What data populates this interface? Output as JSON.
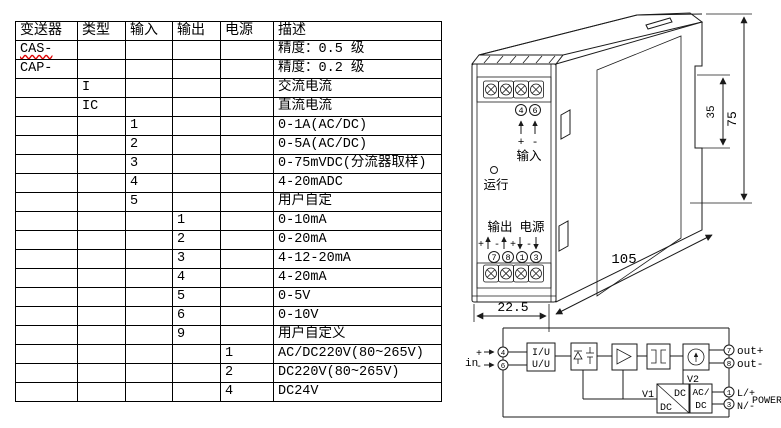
{
  "table": {
    "headers": [
      "变送器",
      "类型",
      "输入",
      "输出",
      "电源",
      "描述"
    ],
    "rows": [
      {
        "cells": [
          "CAS-",
          "",
          "",
          "",
          "",
          "精度：0.5 级"
        ],
        "spell_underline": true
      },
      {
        "cells": [
          "CAP-",
          "",
          "",
          "",
          "",
          "精度：0.2 级"
        ]
      },
      {
        "cells": [
          "",
          "I",
          "",
          "",
          "",
          "交流电流"
        ]
      },
      {
        "cells": [
          "",
          "IC",
          "",
          "",
          "",
          "直流电流"
        ]
      },
      {
        "cells": [
          "",
          "",
          "1",
          "",
          "",
          "0-1A(AC/DC)"
        ]
      },
      {
        "cells": [
          "",
          "",
          "2",
          "",
          "",
          "0-5A(AC/DC)"
        ]
      },
      {
        "cells": [
          "",
          "",
          "3",
          "",
          "",
          "0-75mVDC(分流器取样)"
        ]
      },
      {
        "cells": [
          "",
          "",
          "4",
          "",
          "",
          "4-20mADC"
        ]
      },
      {
        "cells": [
          "",
          "",
          "5",
          "",
          "",
          "用户自定"
        ]
      },
      {
        "cells": [
          "",
          "",
          "",
          "1",
          "",
          "0-10mA"
        ]
      },
      {
        "cells": [
          "",
          "",
          "",
          "2",
          "",
          "0-20mA"
        ]
      },
      {
        "cells": [
          "",
          "",
          "",
          "3",
          "",
          "4-12-20mA"
        ]
      },
      {
        "cells": [
          "",
          "",
          "",
          "4",
          "",
          "4-20mA"
        ]
      },
      {
        "cells": [
          "",
          "",
          "",
          "5",
          "",
          "0-5V"
        ]
      },
      {
        "cells": [
          "",
          "",
          "",
          "6",
          "",
          "0-10V"
        ]
      },
      {
        "cells": [
          "",
          "",
          "",
          "9",
          "",
          "用户自定义"
        ]
      },
      {
        "cells": [
          "",
          "",
          "",
          "",
          "1",
          "AC/DC220V(80~265V)"
        ]
      },
      {
        "cells": [
          "",
          "",
          "",
          "",
          "2",
          "DC220V(80~265V)"
        ]
      },
      {
        "cells": [
          "",
          "",
          "",
          "",
          "4",
          "DC24V"
        ]
      }
    ]
  },
  "device": {
    "input_label": "输入",
    "run_label": "运行",
    "output_label": "输出",
    "power_label": "电源",
    "in_t": [
      "4",
      "6"
    ],
    "out_t": [
      "7",
      "8",
      "1",
      "3"
    ],
    "in_signs": [
      "+",
      "-"
    ],
    "out_signs": [
      "+",
      "-",
      "+",
      "-"
    ],
    "dim_width": "22.5",
    "dim_depth": "105",
    "dim_rail": "35",
    "dim_height": "75"
  },
  "circuit": {
    "in_label": "in",
    "plus": "+",
    "minus": "-",
    "b1a": "I/U",
    "b1b": "U/U",
    "v1": "V1",
    "v2": "V2",
    "dc_top": "DC",
    "dc_bot": "DC",
    "ac1": "AC/",
    "ac2": "DC",
    "out_p": "out+",
    "out_n": "out-",
    "l": "L/+",
    "n": "N/-",
    "power": "POWER",
    "t4": "4",
    "t6": "6",
    "t7": "7",
    "t8": "8",
    "t1": "1",
    "t3": "3"
  }
}
